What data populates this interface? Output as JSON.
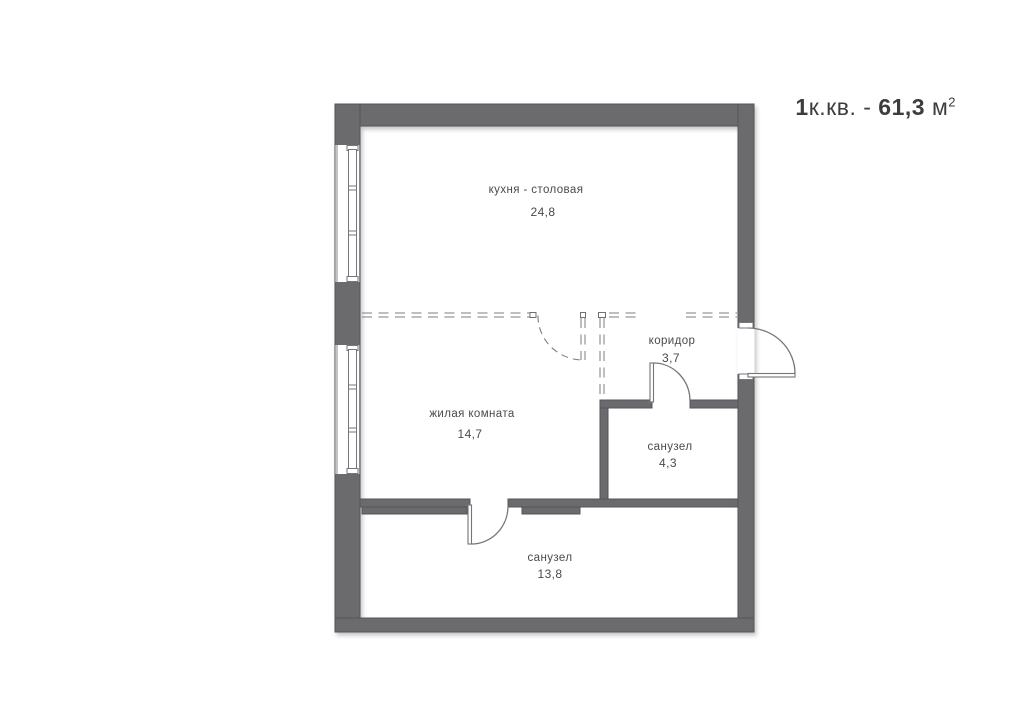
{
  "title": {
    "rooms_count": "1",
    "type_label": "к.кв.",
    "separator": " - ",
    "area_value": "61,3",
    "area_unit": " м",
    "area_power": "2"
  },
  "rooms": [
    {
      "id": "kitchen-dining",
      "name": "кухня - столовая",
      "area": "24,8"
    },
    {
      "id": "living-room",
      "name": "жилая комната",
      "area": "14,7"
    },
    {
      "id": "corridor",
      "name": "коридор",
      "area": "3,7"
    },
    {
      "id": "bathroom",
      "name": "санузел",
      "area": "4,3"
    },
    {
      "id": "bathroom-2",
      "name": "санузел",
      "area": "13,8"
    }
  ],
  "colors": {
    "wall_fill": "#6b6b6d",
    "wall_outline": "#54545a",
    "line": "#7d7d82",
    "label_text": "#4a4a4e",
    "title_text": "#3d3d3f",
    "background": "#ffffff"
  }
}
